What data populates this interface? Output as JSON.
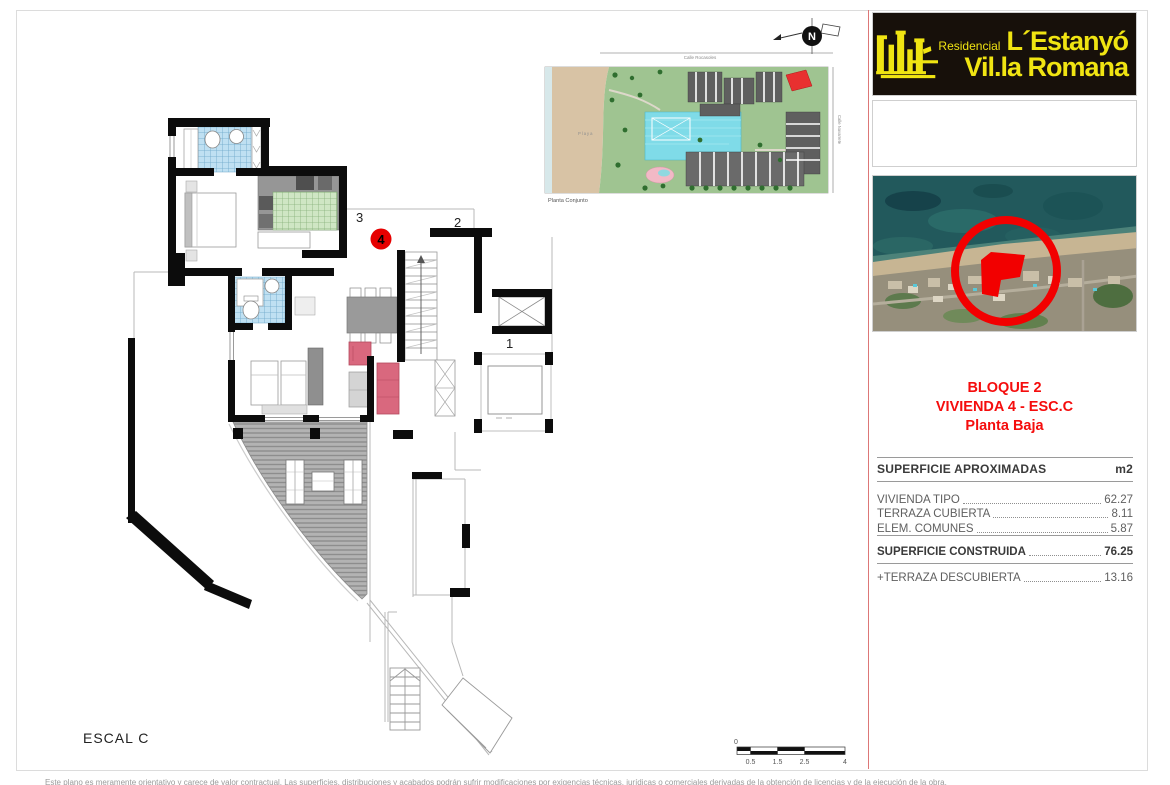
{
  "brand": {
    "residencial": "Residencial",
    "name_line1": "L´Estanyó",
    "name_line2": "Vil.la Romana",
    "bg_color": "#17100a",
    "yellow": "#f0e412"
  },
  "aerial": {
    "marker_color": "#f20000"
  },
  "unit_title": {
    "line1": "BLOQUE 2",
    "line2": "VIVIENDA 4 - ESC.C",
    "line3": "Planta Baja",
    "color": "#f50d0d"
  },
  "areas": {
    "header": "SUPERFICIE APROXIMADAS",
    "unit": "m2",
    "rows": [
      {
        "label": "VIVIENDA TIPO",
        "value": "62.27"
      },
      {
        "label": "TERRAZA CUBIERTA",
        "value": "8.11"
      },
      {
        "label": "ELEM. COMUNES",
        "value": "5.87"
      },
      {
        "label": "SUPERFICIE CONSTRUIDA",
        "value": "76.25"
      },
      {
        "label": "+TERRAZA DESCUBIERTA",
        "value": "13.16"
      }
    ]
  },
  "floorplan": {
    "scale_label": "ESCAL C",
    "labels": {
      "unit1": "1",
      "unit2": "2",
      "unit3": "3",
      "unit4": "4"
    },
    "highlight_color": "#e60000"
  },
  "siteplan": {
    "caption": "Planta Conjunto",
    "beach": "Playa",
    "street_top": "Calle Rocasoles",
    "street_right": "Calle Navarrete"
  },
  "north": {
    "letter": "N"
  },
  "scalebar": {
    "zero": "0",
    "t1": "0.5",
    "t2": "1.5",
    "t3": "2.5",
    "t4": "4"
  },
  "footer": {
    "disclaimer": "Este plano es meramente orientativo y carece de valor contractual. Las superficies, distribuciones y acabados podrán sufrir modificaciones por exigencias técnicas, jurídicas o comerciales derivadas de la obtención de licencias y de la ejecución de la obra."
  }
}
